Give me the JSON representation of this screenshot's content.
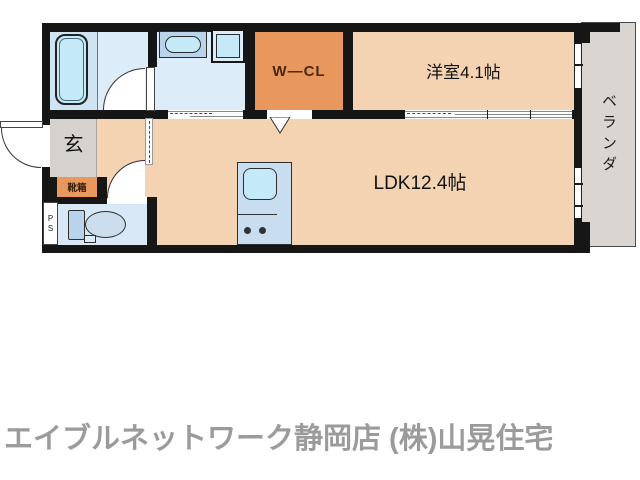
{
  "caption": {
    "text": "エイブルネットワーク静岡店 (株)山晃住宅"
  },
  "rooms": {
    "wcl": {
      "label": "W—CL"
    },
    "yoshitsu": {
      "label": "洋室4.1帖"
    },
    "ldk": {
      "label": "LDK12.4帖"
    },
    "genkan": {
      "label": "玄"
    },
    "shoebox": {
      "label": "靴箱"
    },
    "veranda": {
      "label": "ベランダ"
    },
    "ps": {
      "line1": "P",
      "line2": "S"
    }
  },
  "fixtures": [
    "bathtub",
    "vanity-sink",
    "washing-machine",
    "toilet",
    "kitchen-sink",
    "stove-burners",
    "entry-door",
    "bathroom-door",
    "toilet-door",
    "sliding-door-washroom",
    "sliding-door-yoshitsu",
    "wcl-entry-arrow",
    "window-yoshitsu",
    "window-ldk"
  ],
  "colors": {
    "wall": "#161616",
    "floor": "#f3d3b2",
    "orange": "#e8985c",
    "wet": "#dcecf8",
    "wet_dark": "#cfe3f3",
    "wet_toilet": "#d9e8f6",
    "fixture": "#b9d3ea",
    "cyan": "#c3eaf6",
    "counter": "#c9ddf0",
    "room_gray": "#d5d2ce",
    "veranda": "#dad5d0",
    "caption": "#9b9b9b"
  }
}
